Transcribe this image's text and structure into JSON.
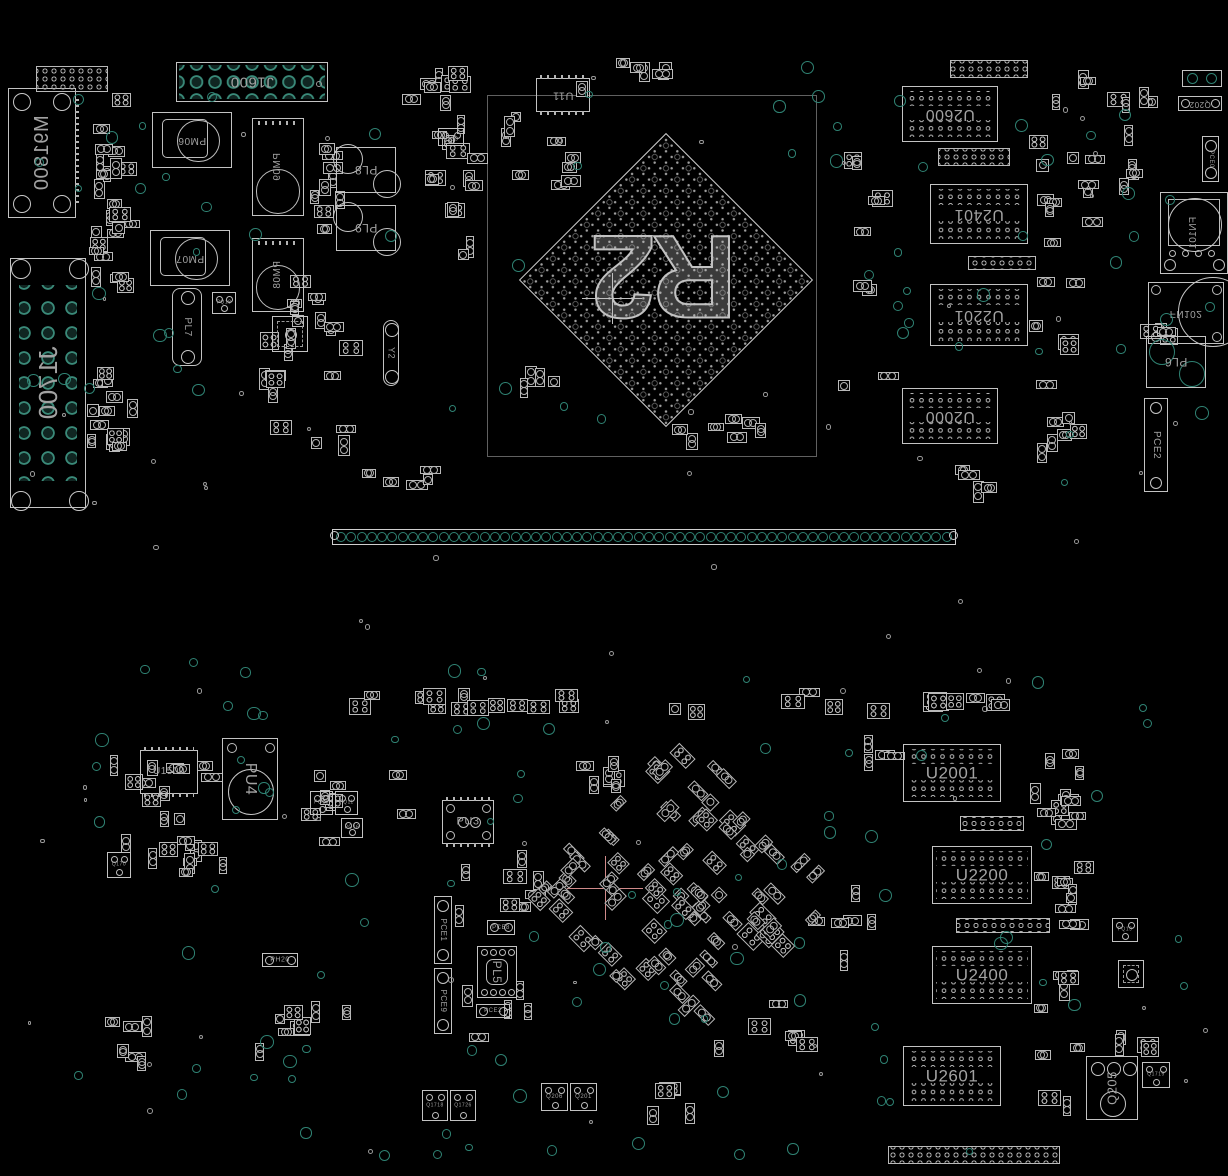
{
  "colors": {
    "bg": "#000000",
    "outline": "#c3c3c3",
    "outline_dim": "#8b8b8b",
    "label": "#a2a2a2",
    "teal": "#2f8273",
    "teal_bright": "#3a8a79",
    "white_ring": "#9a9a9a",
    "pink": "#d08a8a"
  },
  "gpu": {
    "label": "R2",
    "square": {
      "x": 487,
      "y": 95,
      "w": 330,
      "h": 362
    },
    "diamond": {
      "cx": 666,
      "cy": 280,
      "side": 208
    }
  },
  "crosshairs": [
    {
      "x": 612,
      "y": 298,
      "color": "#c0c0c0",
      "arm": 30
    },
    {
      "x": 605,
      "y": 888,
      "color": "#d08a8a",
      "arm": 38
    }
  ],
  "strip": {
    "x": 332,
    "y": 529,
    "w": 624,
    "h": 16,
    "n": 60
  },
  "components": [
    {
      "id": "m91800",
      "t": "connrect",
      "x": 8,
      "y": 88,
      "w": 68,
      "h": 130,
      "label": "M91800",
      "lr": -90,
      "flip": true,
      "fs": 20
    },
    {
      "id": "j1600",
      "t": "gridconn",
      "x": 176,
      "y": 62,
      "w": 152,
      "h": 40,
      "label": "J1600",
      "lr": 180,
      "fs": 15
    },
    {
      "id": "j1700",
      "t": "gridconnv",
      "x": 10,
      "y": 258,
      "w": 76,
      "h": 250,
      "label": "J1700",
      "lr": -90,
      "flip": true,
      "fs": 26
    },
    {
      "id": "pm06",
      "t": "coil",
      "x": 152,
      "y": 112,
      "w": 80,
      "h": 56,
      "label": "PM06",
      "lr": 180,
      "fs": 10
    },
    {
      "id": "pm07",
      "t": "coil",
      "x": 150,
      "y": 230,
      "w": 80,
      "h": 56,
      "label": "PM07",
      "lr": 180,
      "fs": 10
    },
    {
      "id": "pm09",
      "t": "coilv",
      "x": 252,
      "y": 118,
      "w": 52,
      "h": 98,
      "label": "PM09",
      "lr": -90,
      "flip": true,
      "fs": 10
    },
    {
      "id": "pm08",
      "t": "coilv",
      "x": 252,
      "y": 238,
      "w": 52,
      "h": 74,
      "label": "PM08",
      "lr": -90,
      "flip": true,
      "fs": 10
    },
    {
      "id": "pl8",
      "t": "boxcirc",
      "x": 336,
      "y": 147,
      "w": 60,
      "h": 46,
      "label": "PL8",
      "lr": 180,
      "fs": 12
    },
    {
      "id": "pl9",
      "t": "boxcirc",
      "x": 336,
      "y": 205,
      "w": 60,
      "h": 46,
      "label": "PL9",
      "lr": 180,
      "fs": 12
    },
    {
      "id": "pl7",
      "t": "vpill",
      "x": 172,
      "y": 288,
      "w": 30,
      "h": 78,
      "label": "PL7",
      "lr": 90,
      "fs": 10
    },
    {
      "id": "pq18",
      "t": "sq",
      "x": 212,
      "y": 292,
      "w": 24,
      "h": 22,
      "label": "PQ18",
      "lr": 0,
      "fs": 5
    },
    {
      "id": "y2",
      "t": "vpill",
      "x": 383,
      "y": 320,
      "w": 16,
      "h": 66,
      "label": "Y2",
      "lr": 90,
      "fs": 9
    },
    {
      "id": "q210",
      "t": "sq",
      "x": 438,
      "y": 128,
      "w": 26,
      "h": 18,
      "label": "Q210",
      "lr": 180,
      "fs": 5
    },
    {
      "id": "u11",
      "t": "chippads",
      "x": 536,
      "y": 78,
      "w": 54,
      "h": 34,
      "label": "U11",
      "lr": 180,
      "fs": 11
    },
    {
      "id": "u2600",
      "t": "mem",
      "x": 902,
      "y": 86,
      "w": 96,
      "h": 56,
      "label": "U2600",
      "lr": 180,
      "fs": 16
    },
    {
      "id": "u2401",
      "t": "mem",
      "x": 930,
      "y": 184,
      "w": 98,
      "h": 60,
      "label": "U2401",
      "lr": 180,
      "fs": 16
    },
    {
      "id": "u2201",
      "t": "mem",
      "x": 930,
      "y": 284,
      "w": 98,
      "h": 62,
      "label": "U2201",
      "lr": 180,
      "fs": 16
    },
    {
      "id": "u2000",
      "t": "mem",
      "x": 902,
      "y": 388,
      "w": 96,
      "h": 56,
      "label": "U2000",
      "lr": 180,
      "fs": 16
    },
    {
      "id": "q202",
      "t": "hconn",
      "x": 1178,
      "y": 96,
      "w": 44,
      "h": 15,
      "label": "Q202",
      "lr": 180,
      "fs": 8
    },
    {
      "id": "fn101",
      "t": "fan",
      "x": 1160,
      "y": 192,
      "w": 68,
      "h": 82,
      "label": "FN101",
      "lr": -90,
      "flip": true,
      "fs": 10
    },
    {
      "id": "fn102",
      "t": "fan2",
      "x": 1148,
      "y": 282,
      "w": 76,
      "h": 62,
      "label": "FN102",
      "lr": 180,
      "flip": true,
      "fs": 10
    },
    {
      "id": "pl6",
      "t": "boxcirc2",
      "x": 1146,
      "y": 336,
      "w": 60,
      "h": 52,
      "label": "PL6",
      "lr": 180,
      "fs": 12
    },
    {
      "id": "pce0",
      "t": "vconn",
      "x": 1202,
      "y": 136,
      "w": 17,
      "h": 46,
      "label": "PCE0",
      "lr": 90,
      "fs": 6
    },
    {
      "id": "pce2",
      "t": "vconn",
      "x": 1144,
      "y": 398,
      "w": 24,
      "h": 94,
      "label": "PCE2",
      "lr": 90,
      "fs": 10
    },
    {
      "id": "u1500",
      "t": "chippads",
      "x": 140,
      "y": 750,
      "w": 58,
      "h": 44,
      "label": "U1500",
      "lr": 0,
      "fs": 10
    },
    {
      "id": "pu4",
      "t": "coilbig",
      "x": 222,
      "y": 738,
      "w": 56,
      "h": 82,
      "label": "PU4",
      "lr": 90,
      "fs": 16
    },
    {
      "id": "pq10",
      "t": "sq",
      "x": 310,
      "y": 791,
      "w": 23,
      "h": 24,
      "label": "PQ10",
      "lr": 0,
      "fs": 5
    },
    {
      "id": "pq11",
      "t": "sq",
      "x": 335,
      "y": 791,
      "w": 23,
      "h": 24,
      "label": "PQ11",
      "lr": 0,
      "fs": 5
    },
    {
      "id": "pq16",
      "t": "sq",
      "x": 341,
      "y": 818,
      "w": 22,
      "h": 20,
      "label": "PQ16",
      "lr": 0,
      "fs": 5
    },
    {
      "id": "q170",
      "t": "sq",
      "x": 107,
      "y": 852,
      "w": 24,
      "h": 26,
      "label": "Q170",
      "lr": 0,
      "fs": 5
    },
    {
      "id": "ph20",
      "t": "hconn",
      "x": 262,
      "y": 953,
      "w": 36,
      "h": 14,
      "label": "PH20",
      "lr": 0,
      "fs": 7
    },
    {
      "id": "pu3",
      "t": "chippads",
      "x": 442,
      "y": 800,
      "w": 52,
      "h": 44,
      "label": "PU3",
      "lr": 0,
      "fs": 11,
      "circ": true
    },
    {
      "id": "pce1",
      "t": "vconn",
      "x": 434,
      "y": 896,
      "w": 18,
      "h": 68,
      "label": "PCE1",
      "lr": 90,
      "fs": 8
    },
    {
      "id": "pce9",
      "t": "vconn",
      "x": 434,
      "y": 968,
      "w": 18,
      "h": 66,
      "label": "PCE9",
      "lr": 90,
      "fs": 8
    },
    {
      "id": "pce8",
      "t": "hconn",
      "x": 487,
      "y": 920,
      "w": 28,
      "h": 15,
      "label": "PCE8",
      "lr": 0,
      "fs": 6
    },
    {
      "id": "pl5",
      "t": "qfnbig",
      "x": 477,
      "y": 946,
      "w": 40,
      "h": 52,
      "label": "PL5",
      "lr": 90,
      "fs": 12
    },
    {
      "id": "pce2b",
      "t": "hconn",
      "x": 476,
      "y": 1004,
      "w": 34,
      "h": 14,
      "label": "PCE2",
      "lr": 0,
      "fs": 6
    },
    {
      "id": "q206",
      "t": "sq",
      "x": 541,
      "y": 1083,
      "w": 27,
      "h": 28,
      "label": "Q206",
      "lr": 0,
      "fs": 6
    },
    {
      "id": "q201",
      "t": "sq",
      "x": 570,
      "y": 1083,
      "w": 27,
      "h": 28,
      "label": "Q201",
      "lr": 0,
      "fs": 6
    },
    {
      "id": "q1718",
      "t": "sq",
      "x": 422,
      "y": 1090,
      "w": 26,
      "h": 31,
      "label": "Q1718",
      "lr": 0,
      "fs": 5
    },
    {
      "id": "q1726",
      "t": "sq",
      "x": 450,
      "y": 1090,
      "w": 26,
      "h": 31,
      "label": "Q1726",
      "lr": 0,
      "fs": 5
    },
    {
      "id": "u2001",
      "t": "mem",
      "x": 903,
      "y": 744,
      "w": 98,
      "h": 58,
      "label": "U2001",
      "lr": 0,
      "fs": 17
    },
    {
      "id": "u2200",
      "t": "mem",
      "x": 932,
      "y": 846,
      "w": 100,
      "h": 58,
      "label": "U2200",
      "lr": 0,
      "fs": 17
    },
    {
      "id": "u2400",
      "t": "mem",
      "x": 932,
      "y": 946,
      "w": 100,
      "h": 58,
      "label": "U2400",
      "lr": 0,
      "fs": 17
    },
    {
      "id": "u2601",
      "t": "mem",
      "x": 903,
      "y": 1046,
      "w": 98,
      "h": 60,
      "label": "U2601",
      "lr": 0,
      "fs": 17
    },
    {
      "id": "q205",
      "t": "q205",
      "x": 1086,
      "y": 1056,
      "w": 52,
      "h": 64,
      "label": "Q205",
      "lr": -90,
      "fs": 13
    },
    {
      "id": "q1719",
      "t": "sq",
      "x": 1142,
      "y": 1062,
      "w": 28,
      "h": 26,
      "label": "Q1719",
      "lr": 0,
      "fs": 5
    },
    {
      "id": "pq19",
      "t": "sq",
      "x": 1112,
      "y": 918,
      "w": 26,
      "h": 24,
      "label": "PQ19",
      "lr": 0,
      "fs": 5
    },
    {
      "id": "qfna",
      "t": "qfn",
      "x": 272,
      "y": 316,
      "w": 36,
      "h": 36
    },
    {
      "id": "qfnb",
      "t": "qfn",
      "x": 1118,
      "y": 960,
      "w": 26,
      "h": 28
    },
    {
      "id": "mteal",
      "t": "sqteal",
      "x": 1182,
      "y": 70,
      "w": 40,
      "h": 17
    },
    {
      "id": "h1",
      "t": "header",
      "x": 938,
      "y": 148,
      "w": 72,
      "h": 18
    },
    {
      "id": "h2",
      "t": "header",
      "x": 968,
      "y": 256,
      "w": 68,
      "h": 14
    },
    {
      "id": "h3",
      "t": "header",
      "x": 950,
      "y": 60,
      "w": 78,
      "h": 18
    },
    {
      "id": "h4",
      "t": "header",
      "x": 960,
      "y": 816,
      "w": 64,
      "h": 15
    },
    {
      "id": "h5",
      "t": "header",
      "x": 956,
      "y": 918,
      "w": 94,
      "h": 15
    },
    {
      "id": "h6",
      "t": "header",
      "x": 888,
      "y": 1146,
      "w": 172,
      "h": 18
    },
    {
      "id": "h7",
      "t": "header",
      "x": 36,
      "y": 66,
      "w": 72,
      "h": 26
    }
  ],
  "clusters": [
    {
      "x": 86,
      "y": 84,
      "w": 58,
      "h": 225,
      "n": 24
    },
    {
      "x": 84,
      "y": 320,
      "w": 66,
      "h": 145,
      "n": 14
    },
    {
      "x": 306,
      "y": 128,
      "w": 56,
      "h": 110,
      "n": 9
    },
    {
      "x": 258,
      "y": 268,
      "w": 102,
      "h": 195,
      "n": 22
    },
    {
      "x": 398,
      "y": 62,
      "w": 92,
      "h": 62,
      "n": 8
    },
    {
      "x": 420,
      "y": 98,
      "w": 72,
      "h": 92,
      "n": 7
    },
    {
      "x": 445,
      "y": 150,
      "w": 44,
      "h": 116,
      "n": 6
    },
    {
      "x": 495,
      "y": 112,
      "w": 96,
      "h": 96,
      "n": 9
    },
    {
      "x": 560,
      "y": 58,
      "w": 150,
      "h": 38,
      "n": 7
    },
    {
      "x": 835,
      "y": 95,
      "w": 64,
      "h": 360,
      "n": 9
    },
    {
      "x": 1028,
      "y": 62,
      "w": 80,
      "h": 402,
      "n": 26
    },
    {
      "x": 1105,
      "y": 85,
      "w": 70,
      "h": 118,
      "n": 9
    },
    {
      "x": 1138,
      "y": 322,
      "w": 44,
      "h": 48,
      "n": 4
    },
    {
      "x": 515,
      "y": 360,
      "w": 56,
      "h": 46,
      "n": 4
    },
    {
      "x": 645,
      "y": 410,
      "w": 150,
      "h": 48,
      "n": 7
    },
    {
      "x": 335,
      "y": 462,
      "w": 146,
      "h": 32,
      "n": 5
    },
    {
      "x": 948,
      "y": 452,
      "w": 70,
      "h": 45,
      "n": 4
    },
    {
      "x": 95,
      "y": 732,
      "w": 132,
      "h": 126,
      "n": 17
    },
    {
      "x": 140,
      "y": 838,
      "w": 122,
      "h": 44,
      "n": 6
    },
    {
      "x": 300,
      "y": 765,
      "w": 132,
      "h": 92,
      "n": 9
    },
    {
      "x": 255,
      "y": 928,
      "w": 122,
      "h": 140,
      "n": 8
    },
    {
      "x": 455,
      "y": 848,
      "w": 118,
      "h": 200,
      "n": 13
    },
    {
      "x": 345,
      "y": 686,
      "w": 608,
      "h": 32,
      "n": 22,
      "style": "quad"
    },
    {
      "x": 555,
      "y": 745,
      "w": 92,
      "h": 72,
      "n": 6
    },
    {
      "x": 860,
      "y": 735,
      "w": 62,
      "h": 52,
      "n": 4
    },
    {
      "x": 1030,
      "y": 730,
      "w": 66,
      "h": 392,
      "n": 30
    },
    {
      "x": 1098,
      "y": 1030,
      "w": 72,
      "h": 28,
      "n": 4
    },
    {
      "x": 95,
      "y": 1008,
      "w": 122,
      "h": 62,
      "n": 6
    },
    {
      "x": 630,
      "y": 1075,
      "w": 92,
      "h": 46,
      "n": 5
    },
    {
      "x": 700,
      "y": 990,
      "w": 122,
      "h": 72,
      "n": 6
    },
    {
      "x": 798,
      "y": 878,
      "w": 92,
      "h": 92,
      "n": 6
    },
    {
      "x": 905,
      "y": 688,
      "w": 118,
      "h": 26,
      "n": 5,
      "style": "quad"
    }
  ],
  "diamond_cluster": {
    "cx": 688,
    "cy": 888,
    "r": 150,
    "n": 80
  },
  "testpoints": {
    "regions": [
      {
        "x": 20,
        "y": 55,
        "w": 1190,
        "h": 435,
        "n": 60
      },
      {
        "x": 60,
        "y": 655,
        "w": 1130,
        "h": 495,
        "n": 90
      }
    ],
    "micro_n": 70
  },
  "seed": 1337
}
